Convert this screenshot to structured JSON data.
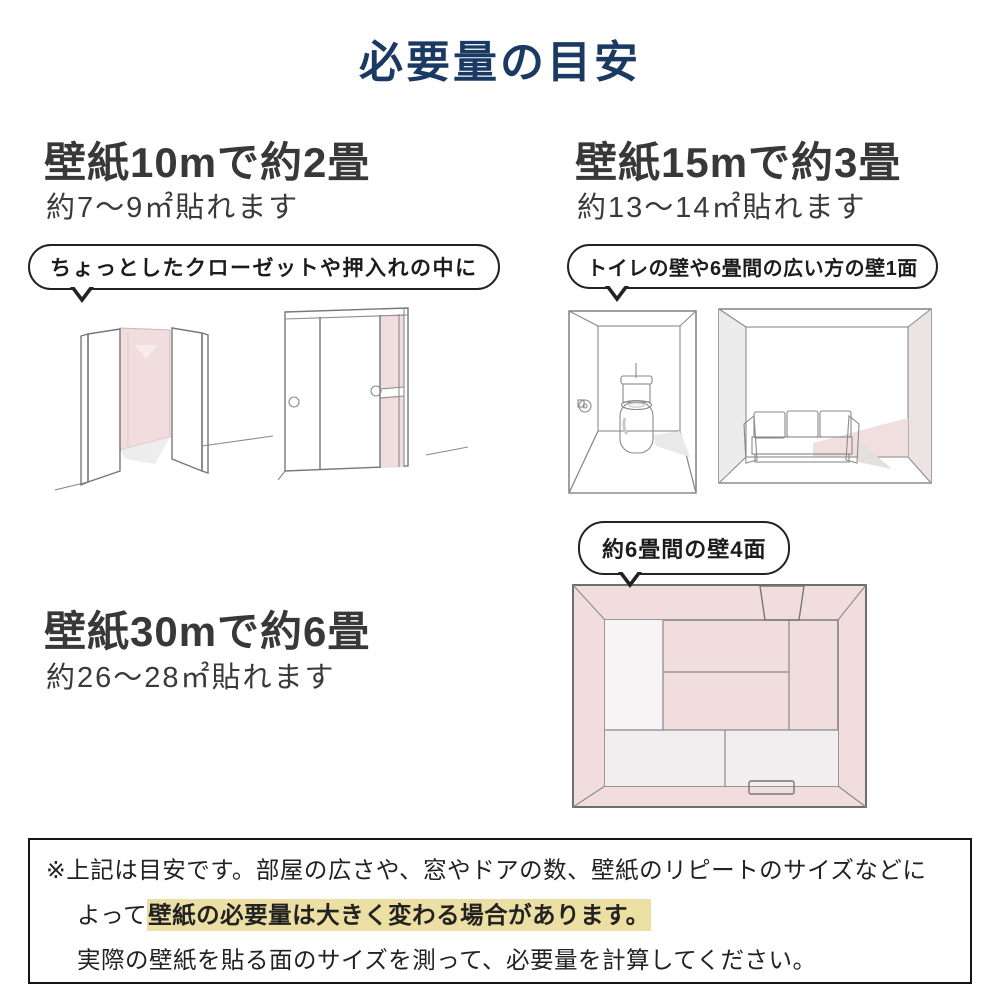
{
  "page": {
    "title": "必要量の目安"
  },
  "colors": {
    "title_navy": "#1b3a63",
    "heading_gray": "#383838",
    "pink_wall": "#f1dddd",
    "pink_wall_dark": "#e6d3d4",
    "gray_wall": "#ececec",
    "highlight_yellow": "#ecdfa3",
    "bubble_border": "#222222",
    "note_border": "#151515"
  },
  "sections": {
    "s10": {
      "heading": "壁紙10mで約2畳",
      "sub": "約7〜9㎡貼れます",
      "bubble": "ちょっとしたクローゼットや押入れの中に"
    },
    "s15": {
      "heading": "壁紙15mで約3畳",
      "sub": "約13〜14㎡貼れます",
      "bubble": "トイレの壁や6畳間の広い方の壁1面"
    },
    "s30": {
      "heading": "壁紙30mで約6畳",
      "sub": "約26〜28㎡貼れます",
      "bubble": "約6畳間の壁4面"
    }
  },
  "note": {
    "line1": "※上記は目安です。部屋の広さや、窓やドアの数、壁紙のリピートのサイズなどに",
    "line2_prefix": "よって",
    "line2_highlight": "壁紙の必要量は大きく変わる場合があります。",
    "line3": "実際の壁紙を貼る面のサイズを測って、必要量を計算してください。"
  },
  "illustrations": {
    "open_closet": "open-closet-with-pink-interior",
    "sliding_closet": "sliding-door-closet-with-pink-interior",
    "toilet_room": "toilet-room-pink-walls",
    "sofa_room": "six-mat-room-one-pink-wall-with-sofa",
    "room_top": "six-mat-room-top-view-four-pink-walls"
  }
}
